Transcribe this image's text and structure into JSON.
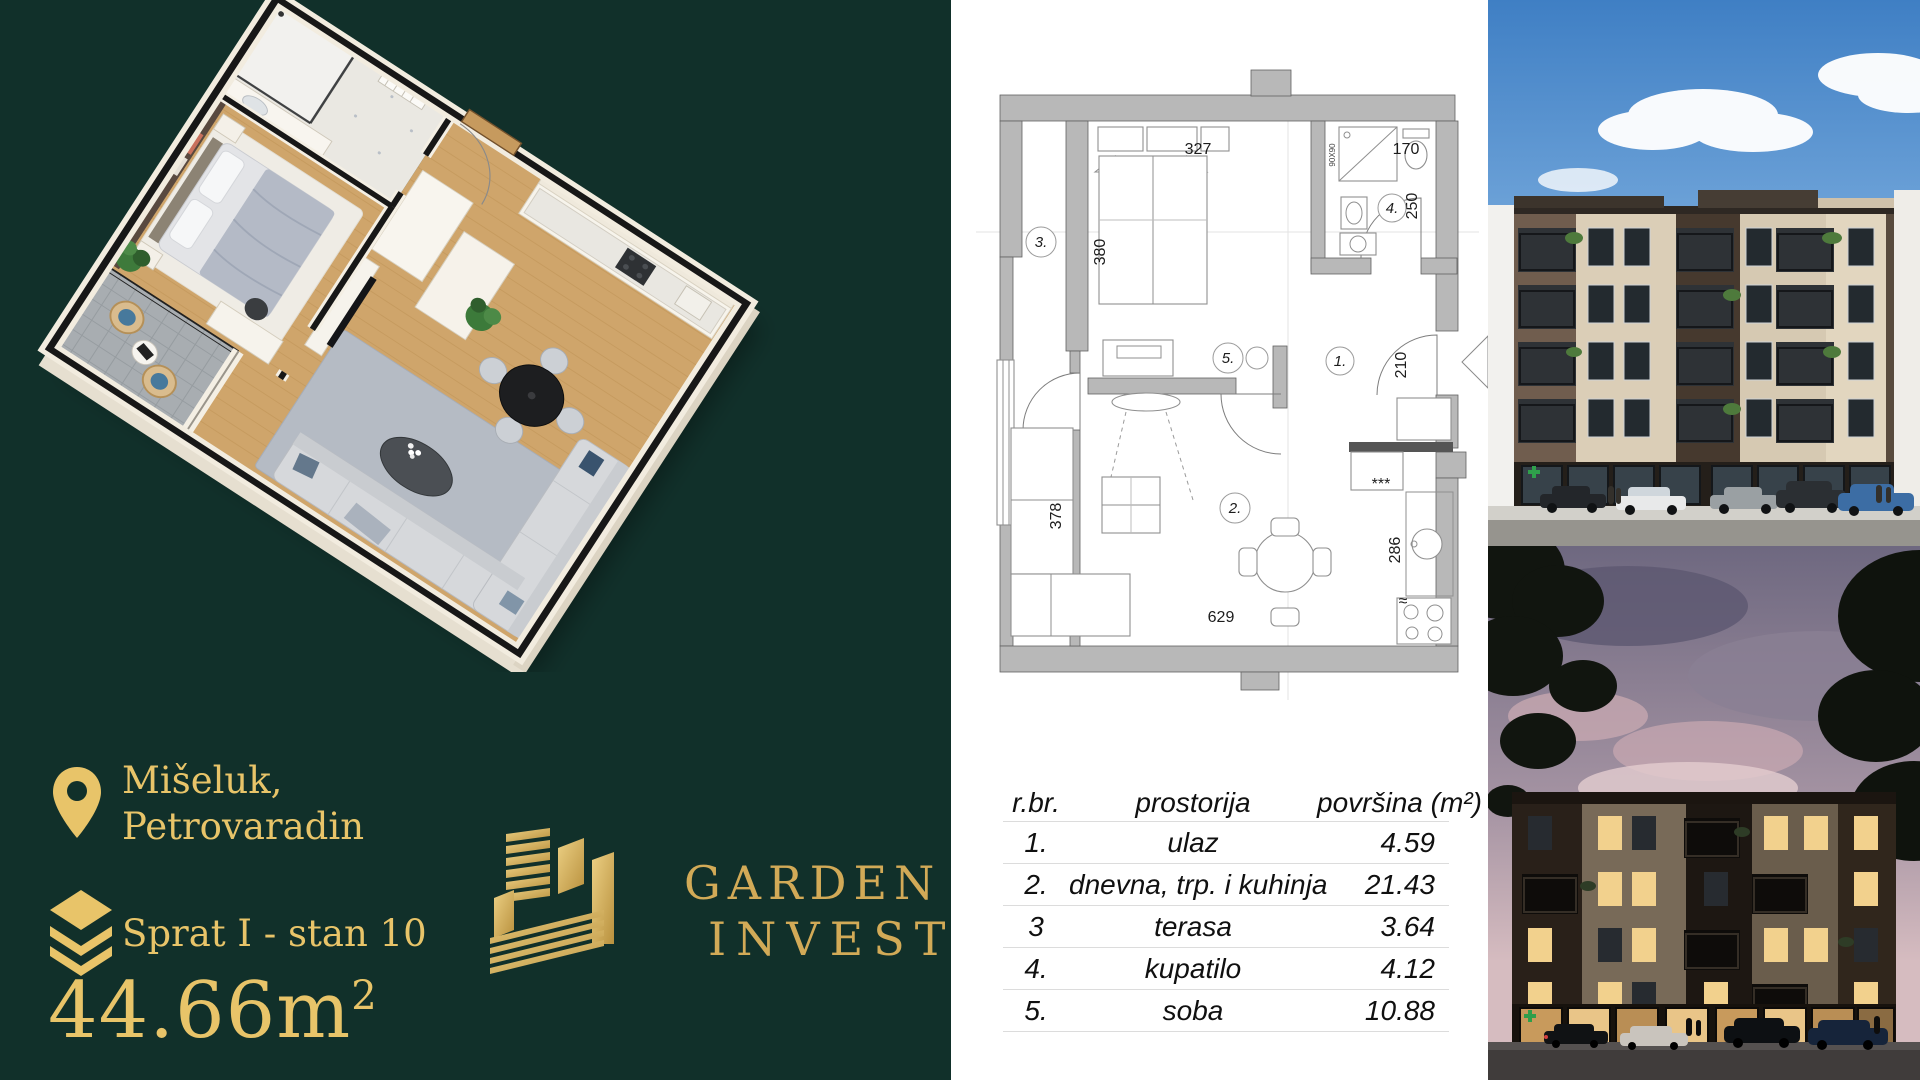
{
  "flyer": {
    "location": {
      "line1": "Mišeluk,",
      "line2": "Petrovaradin"
    },
    "floor_unit": "Sprat I - stan 10",
    "area": {
      "value": "44.66m",
      "sup": "2"
    },
    "logo": {
      "line1": "GARDEN",
      "line2": "INVEST"
    },
    "colors": {
      "background_green": "#11302a",
      "gold": "#e8c469",
      "logo_gold": "#d2aa57"
    }
  },
  "plan": {
    "labels": {
      "hall": "1.",
      "living": "2.",
      "terrace": "3.",
      "bath": "4.",
      "bedroom": "5."
    },
    "dims": {
      "bed_width": "327",
      "bed_depth": "380",
      "bath_width": "170",
      "bath_depth": "250",
      "hall_height": "210",
      "living_left": "378",
      "living_bottom": "629",
      "kitchen_right": "286"
    },
    "shower_size": "90X90",
    "kitchen_dots": "***",
    "hob_mark": "≈"
  },
  "table": {
    "headers": {
      "no": "r.br.",
      "room": "prostorija",
      "area": "površina (m²)"
    },
    "rows": [
      {
        "no": "1.",
        "room": "ulaz",
        "area": "4.59"
      },
      {
        "no": "2.",
        "room": "dnevna, trp. i kuhinja",
        "area": "21.43"
      },
      {
        "no": "3",
        "room": "terasa",
        "area": "3.64"
      },
      {
        "no": "4.",
        "room": "kupatilo",
        "area": "4.12"
      },
      {
        "no": "5.",
        "room": "soba",
        "area": "10.88"
      }
    ]
  }
}
